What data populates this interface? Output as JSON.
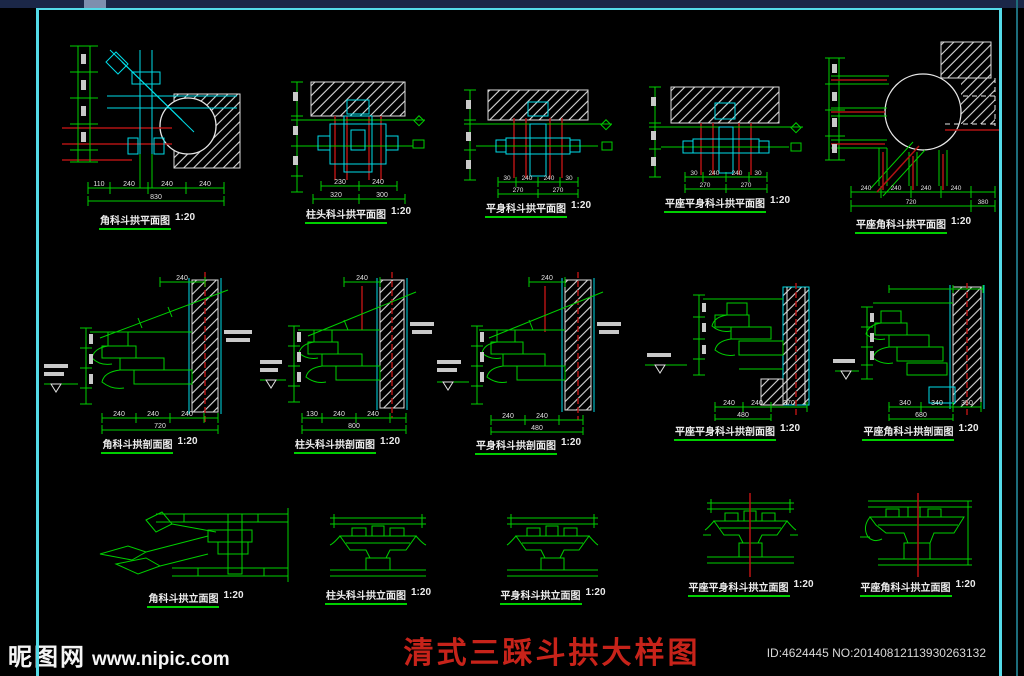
{
  "frame": {
    "border_color": "#54dbe8"
  },
  "title": {
    "text": "清式三踩斗拱大样图",
    "color": "#c7231a"
  },
  "watermark": {
    "logo": "昵图网",
    "site": "www.nipic.com"
  },
  "footer": {
    "id_text": "ID:4624445 NO:20140812113930263132"
  },
  "drawings": [
    {
      "label": "角科斗拱平面图",
      "scale": "1:20",
      "dims_bottom": [
        "110",
        "240",
        "240",
        "240"
      ],
      "dim_total": "830"
    },
    {
      "label": "柱头科斗拱平面图",
      "scale": "1:20",
      "dims_bottom": [
        "230",
        "240"
      ],
      "dims_total": [
        "320",
        "300"
      ]
    },
    {
      "label": "平身科斗拱平面图",
      "scale": "1:20",
      "dims_bottom": [
        "30",
        "240",
        "240",
        "30"
      ],
      "dims_total": [
        "270",
        "270"
      ]
    },
    {
      "label": "平座平身科斗拱平面图",
      "scale": "1:20",
      "dims_bottom": [
        "30",
        "240",
        "240",
        "30"
      ],
      "dims_total": [
        "270",
        "270"
      ]
    },
    {
      "label": "平座角科斗拱平面图",
      "scale": "1:20",
      "dims_bottom": [
        "240",
        "240",
        "240",
        "240"
      ],
      "dims_total": [
        "720",
        "380"
      ]
    },
    {
      "label": "角科斗拱剖面图",
      "scale": "1:20",
      "dim_top": "240",
      "dims_bottom": [
        "240",
        "240",
        "240"
      ],
      "dim_total": "720"
    },
    {
      "label": "柱头科斗拱剖面图",
      "scale": "1:20",
      "dim_top": "240",
      "dims_bottom": [
        "130",
        "240",
        "240"
      ],
      "dim_total": "800"
    },
    {
      "label": "平身科斗拱剖面图",
      "scale": "1:20",
      "dim_top": "240",
      "dims_bottom": [
        "240",
        "240"
      ],
      "dim_total": "480"
    },
    {
      "label": "平座平身科斗拱剖面图",
      "scale": "1:20",
      "dims_bottom": [
        "240",
        "240",
        "370"
      ],
      "dim_total": "480"
    },
    {
      "label": "平座角科斗拱剖面图",
      "scale": "1:20",
      "dims_bottom": [
        "340",
        "340",
        "350"
      ],
      "dim_total": "680"
    },
    {
      "label": "角科斗拱立面图",
      "scale": "1:20"
    },
    {
      "label": "柱头科斗拱立面图",
      "scale": "1:20"
    },
    {
      "label": "平身科斗拱立面图",
      "scale": "1:20"
    },
    {
      "label": "平座平身科斗拱立面图",
      "scale": "1:20"
    },
    {
      "label": "平座角科斗拱立面图",
      "scale": "1:20"
    }
  ]
}
